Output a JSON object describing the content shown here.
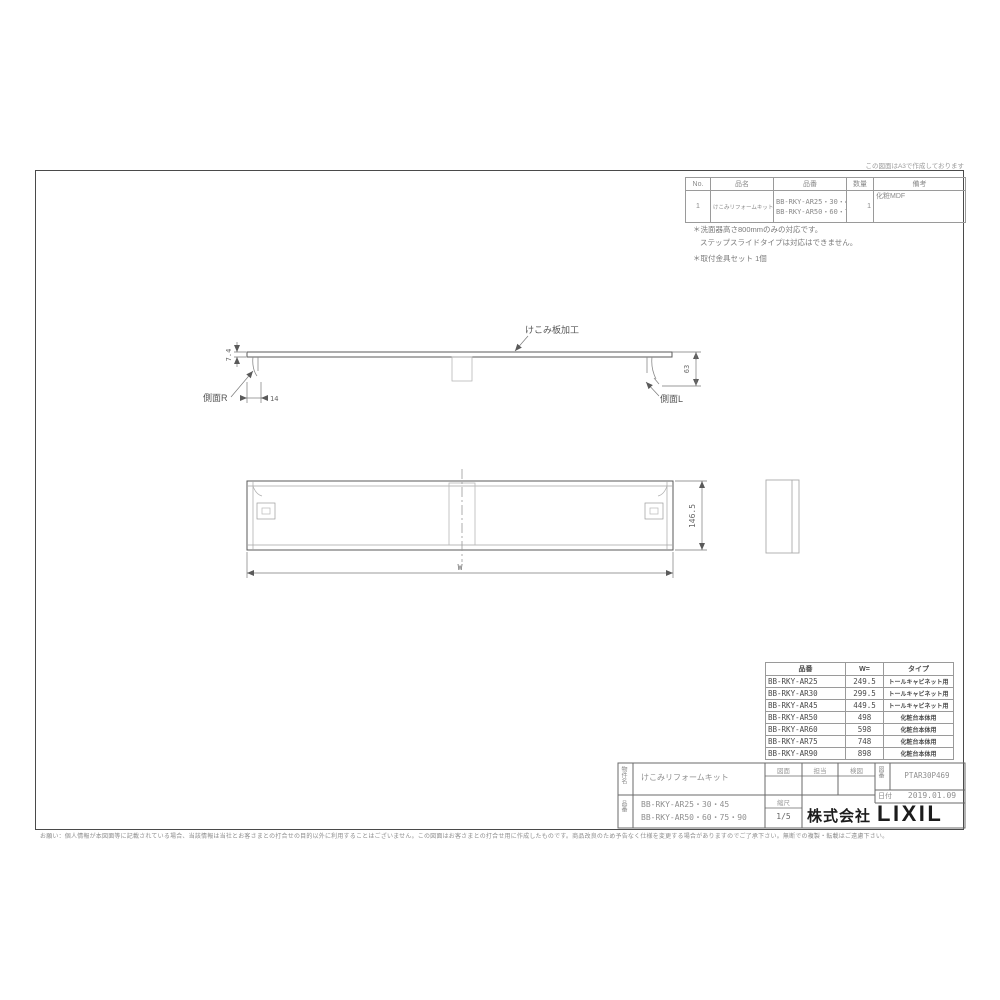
{
  "meta": {
    "top_note": "この図面はA3で作成しております",
    "disclaimer": "お願い：個人情報が本図面等に記載されている場合、当該情報は当社とお客さまとの打合せの目的以外に利用することはございません。この図面はお客さまとの打合せ用に作成したものです。商品改良のため予告なく仕様を変更する場合がありますのでご了承下さい。無断での複製・転載はご遠慮下さい。"
  },
  "parts_table": {
    "h_no": "No.",
    "h_name": "品名",
    "h_number": "品番",
    "h_qty": "数量",
    "h_remarks": "備考",
    "no": "1",
    "name": "けこみリフォームキット",
    "number1": "BB-RKY-AR25・30・45",
    "number2": "BB-RKY-AR50・60・75・90",
    "qty": "1",
    "remarks": "化粧MDF"
  },
  "notes": {
    "n1": "＊洗面器高さ800mmのみの対応です。",
    "n2": "ステップスライドタイプは対応はできません。",
    "n3": "＊取付金具セット 1個"
  },
  "drawing": {
    "kekomi_label": "けこみ板加工",
    "side_r": "側面R",
    "side_l": "側面L",
    "dim_thickness": "7.4",
    "dim_offset": "14",
    "dim_end_height": "63",
    "dim_body_height": "146.5",
    "dim_width": "W"
  },
  "spec_table": {
    "h_number": "品番",
    "h_w": "W=",
    "h_type": "タイプ",
    "rows": [
      {
        "number": "BB-RKY-AR25",
        "w": "249.5",
        "type": "トールキャビネット用"
      },
      {
        "number": "BB-RKY-AR30",
        "w": "299.5",
        "type": "トールキャビネット用"
      },
      {
        "number": "BB-RKY-AR45",
        "w": "449.5",
        "type": "トールキャビネット用"
      },
      {
        "number": "BB-RKY-AR50",
        "w": "498",
        "type": "化粧台本体用"
      },
      {
        "number": "BB-RKY-AR60",
        "w": "598",
        "type": "化粧台本体用"
      },
      {
        "number": "BB-RKY-AR75",
        "w": "748",
        "type": "化粧台本体用"
      },
      {
        "number": "BB-RKY-AR90",
        "w": "898",
        "type": "化粧台本体用"
      }
    ]
  },
  "title_block": {
    "project_label": "物件名",
    "project": "けこみリフォームキット",
    "col1": "図面",
    "col2": "担当",
    "col3": "検図",
    "drawing_no_label": "図番",
    "drawing_no": "PTAR30P469",
    "date_label": "日付",
    "date": "2019.01.09",
    "part_label": "品番",
    "part1": "BB-RKY-AR25・30・45",
    "part2": "BB-RKY-AR50・60・75・90",
    "scale_label": "縮尺",
    "scale": "1/5",
    "company_prefix": "株式会社",
    "company_name": "LIXIL"
  }
}
